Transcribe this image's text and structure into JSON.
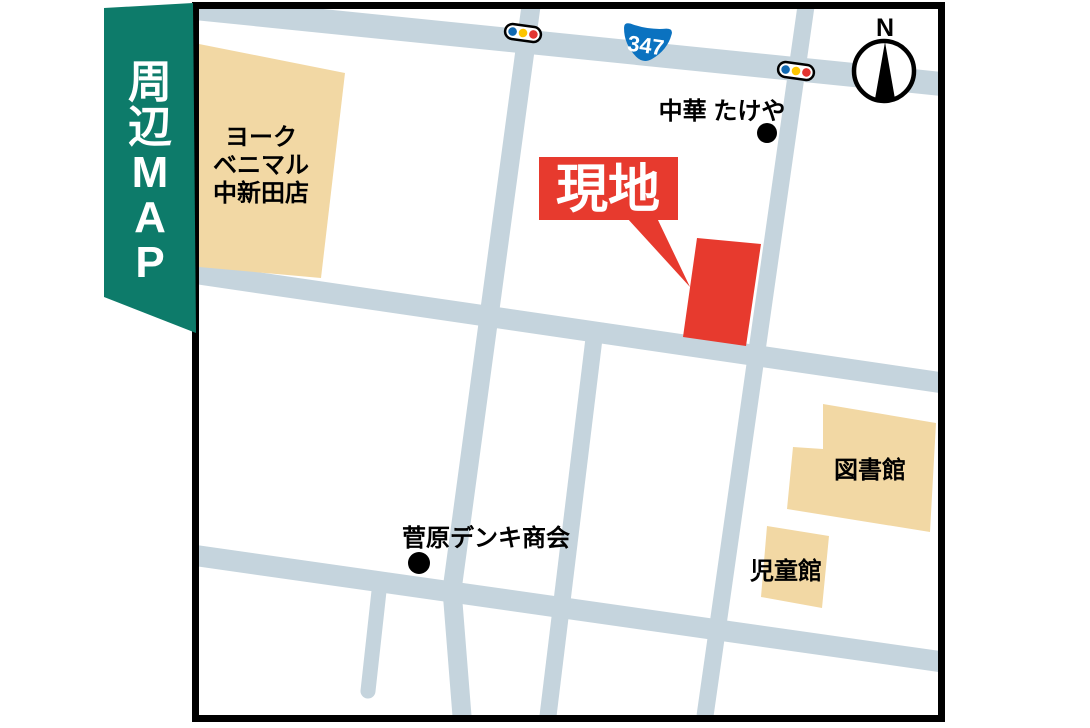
{
  "ribbon": {
    "label": "周辺MAP",
    "chars": [
      "周",
      "辺",
      "M",
      "A",
      "P"
    ]
  },
  "map": {
    "site": {
      "callout_label": "現地"
    },
    "route_badge": {
      "number": "347"
    },
    "compass": {
      "north_label": "N"
    },
    "landmarks": {
      "supermarket": {
        "line1": "ヨーク",
        "line2": "ベニマル",
        "line3": "中新田店"
      },
      "restaurant": {
        "name": "中華 たけや"
      },
      "electronics_store": {
        "name": "菅原デンキ商会"
      },
      "library": {
        "name": "図書館"
      },
      "childrens_hall": {
        "name": "児童館"
      }
    },
    "colors": {
      "road": "#c5d4dd",
      "building": "#f2d8a4",
      "accent_red": "#e73a2e",
      "ribbon_teal": "#0d7b6a",
      "route_badge_blue": "#0b72c0",
      "signal_blue": "#1168b0",
      "signal_yellow": "#fdc500",
      "signal_red": "#e33430",
      "frame_black": "#000000"
    }
  }
}
